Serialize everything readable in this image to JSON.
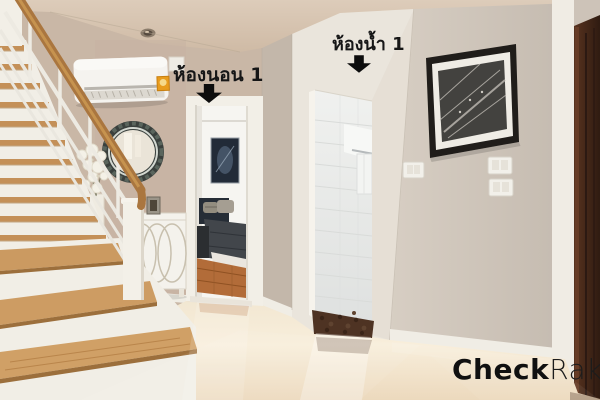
{
  "labels": {
    "bedroom": "ห้องนอน 1",
    "bathroom": "ห้องน้ำ 1"
  },
  "watermark": {
    "brand_bold": "Check",
    "brand_light": "Raka"
  },
  "icons": {
    "bedroom_arrow": "down-block-arrow",
    "bathroom_arrow": "down-block-arrow"
  },
  "palette": {
    "ceiling": "#d5c3b0",
    "wall_left_beige": "#c9b7a6",
    "wall_right_greige": "#ccc2b7",
    "bathroom_wall_white": "#eae5dc",
    "trim_white": "#f1eee7",
    "floor_cream": "#f3e5cd",
    "stair_tread_wood": "#cb9a61",
    "handrail_wood": "#aa763f",
    "bedroom_floor_wood": "#b26c39",
    "dark_door_wood": "#46281b",
    "label_text": "#161616",
    "watermark_color": "#101010"
  }
}
